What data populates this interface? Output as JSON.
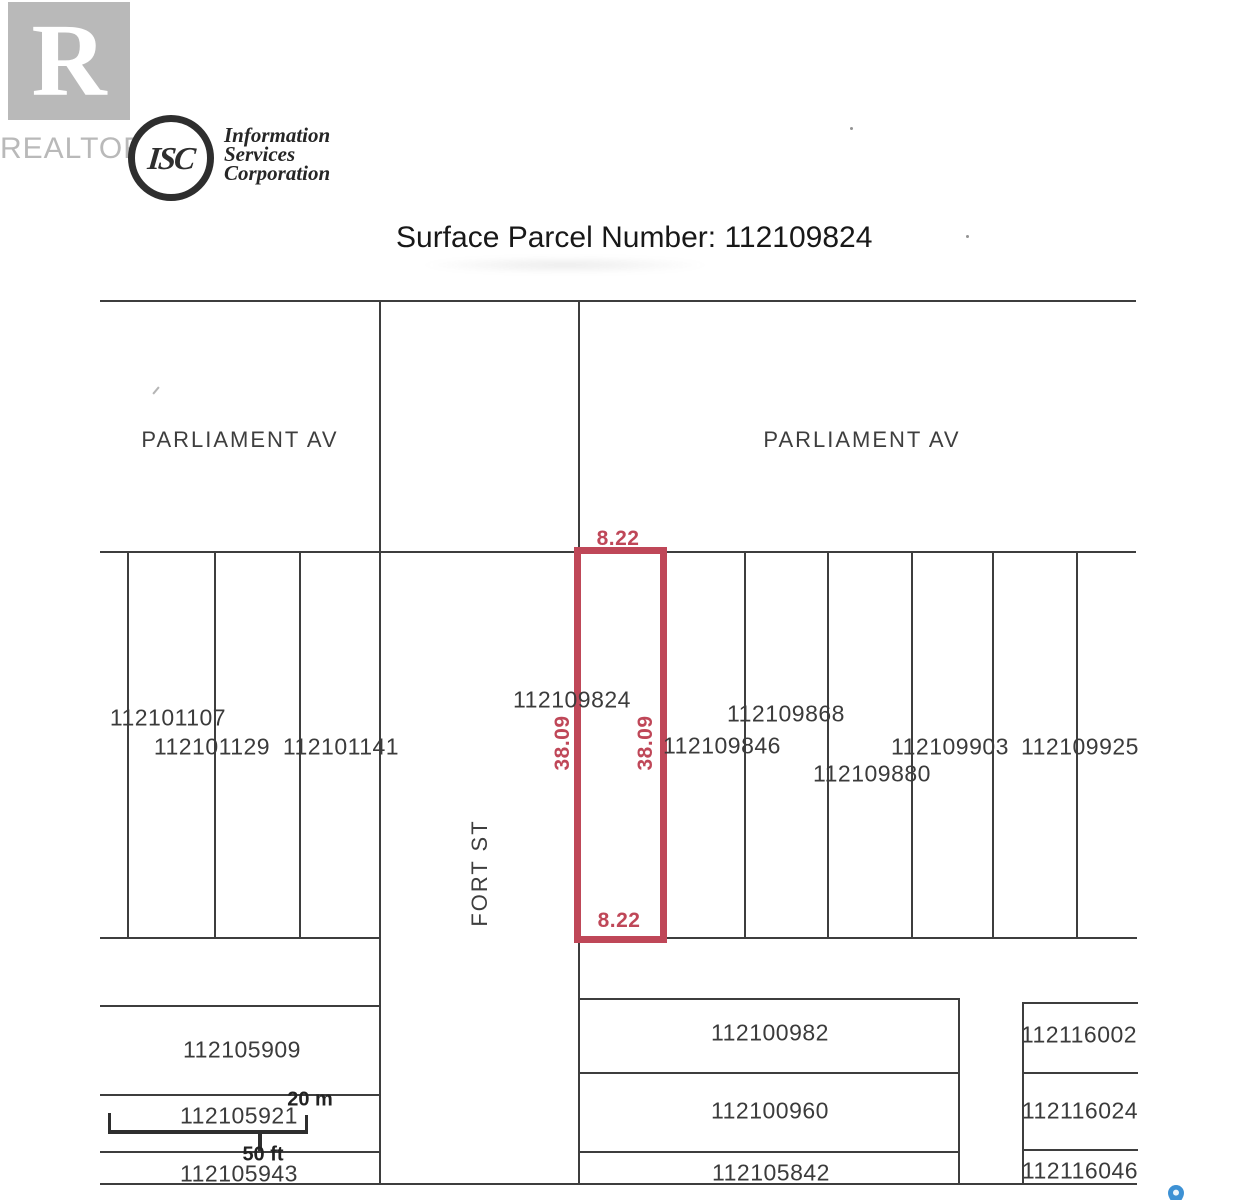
{
  "header": {
    "realtor": {
      "letter": "R",
      "label": "REALTOR",
      "color": "#b9b9b9"
    },
    "isc": {
      "monogram": "ISC",
      "name_lines": [
        "Information",
        "Services",
        "Corporation"
      ]
    },
    "title": "Surface Parcel Number: 112109824"
  },
  "map": {
    "line_color": "#3e3e3e",
    "streets": [
      {
        "label": "PARLIAMENT AV",
        "x": 240,
        "y": 440,
        "rot": 0
      },
      {
        "label": "PARLIAMENT AV",
        "x": 862,
        "y": 440,
        "rot": 0
      },
      {
        "label": "FORT ST",
        "x": 480,
        "y": 873,
        "rot": -90
      }
    ],
    "parcels": [
      {
        "label": "112101107",
        "x": 168,
        "y": 718
      },
      {
        "label": "112101129",
        "x": 212,
        "y": 747
      },
      {
        "label": "112101141",
        "x": 341,
        "y": 747
      },
      {
        "label": "112109824",
        "x": 572,
        "y": 700
      },
      {
        "label": "112109868",
        "x": 786,
        "y": 714
      },
      {
        "label": "112109846",
        "x": 722,
        "y": 746
      },
      {
        "label": "112109880",
        "x": 872,
        "y": 774
      },
      {
        "label": "112109903",
        "x": 950,
        "y": 747
      },
      {
        "label": "112109925",
        "x": 1080,
        "y": 747
      },
      {
        "label": "112105909",
        "x": 242,
        "y": 1050
      },
      {
        "label": "112105921",
        "x": 239,
        "y": 1116
      },
      {
        "label": "112105943",
        "x": 239,
        "y": 1174
      },
      {
        "label": "112100982",
        "x": 770,
        "y": 1033
      },
      {
        "label": "112100960",
        "x": 770,
        "y": 1111
      },
      {
        "label": "112105842",
        "x": 771,
        "y": 1173
      },
      {
        "label": "112116002",
        "x": 1079,
        "y": 1035
      },
      {
        "label": "112116024",
        "x": 1080,
        "y": 1111
      },
      {
        "label": "112116046",
        "x": 1080,
        "y": 1171
      }
    ],
    "highlight": {
      "x": 578,
      "y": 551,
      "w": 84,
      "h": 387,
      "stroke": 7,
      "color": "#bf4758",
      "dims": [
        {
          "text": "8.22",
          "x": 618,
          "y": 539,
          "rot": 0
        },
        {
          "text": "8.22",
          "x": 619,
          "y": 921,
          "rot": 0
        },
        {
          "text": "38.09",
          "x": 563,
          "y": 743,
          "rot": -90
        },
        {
          "text": "38.09",
          "x": 646,
          "y": 743,
          "rot": -90
        }
      ]
    },
    "scale": {
      "metric": "20 m",
      "imperial": "50 ft"
    },
    "pin_color": "#3d91d4",
    "lines": {
      "h": [
        {
          "x": 100,
          "y": 300,
          "w": 1036
        },
        {
          "x": 100,
          "y": 551,
          "w": 1036
        },
        {
          "x": 100,
          "y": 937,
          "w": 279
        },
        {
          "x": 660,
          "y": 937,
          "w": 477
        },
        {
          "x": 100,
          "y": 1005,
          "w": 279
        },
        {
          "x": 578,
          "y": 998,
          "w": 381
        },
        {
          "x": 1022,
          "y": 1002,
          "w": 116
        },
        {
          "x": 100,
          "y": 1094,
          "w": 279
        },
        {
          "x": 578,
          "y": 1072,
          "w": 381
        },
        {
          "x": 1022,
          "y": 1072,
          "w": 116
        },
        {
          "x": 100,
          "y": 1151,
          "w": 279
        },
        {
          "x": 578,
          "y": 1151,
          "w": 381
        },
        {
          "x": 1022,
          "y": 1149,
          "w": 116
        },
        {
          "x": 100,
          "y": 1183,
          "w": 1037
        }
      ],
      "v": [
        {
          "x": 127,
          "y": 551,
          "h": 387
        },
        {
          "x": 214,
          "y": 551,
          "h": 387
        },
        {
          "x": 299,
          "y": 551,
          "h": 387
        },
        {
          "x": 379,
          "y": 300,
          "h": 883
        },
        {
          "x": 578,
          "y": 300,
          "h": 883
        },
        {
          "x": 744,
          "y": 551,
          "h": 387
        },
        {
          "x": 827,
          "y": 551,
          "h": 387
        },
        {
          "x": 911,
          "y": 551,
          "h": 387
        },
        {
          "x": 992,
          "y": 551,
          "h": 387
        },
        {
          "x": 1076,
          "y": 551,
          "h": 387
        },
        {
          "x": 958,
          "y": 998,
          "h": 186
        },
        {
          "x": 1022,
          "y": 1002,
          "h": 182
        }
      ]
    },
    "scalebar_geom": {
      "bar": {
        "x": 108,
        "y": 1130,
        "w": 200,
        "h": 4
      },
      "ticks": [
        {
          "x": 108,
          "y": 1113,
          "w": 3,
          "h": 21
        },
        {
          "x": 305,
          "y": 1115,
          "w": 3,
          "h": 19
        },
        {
          "x": 258,
          "y": 1133,
          "w": 4,
          "h": 18
        }
      ],
      "metric_label_pos": {
        "x": 310,
        "y": 1100
      },
      "imperial_label_pos": {
        "x": 263,
        "y": 1155
      }
    }
  }
}
